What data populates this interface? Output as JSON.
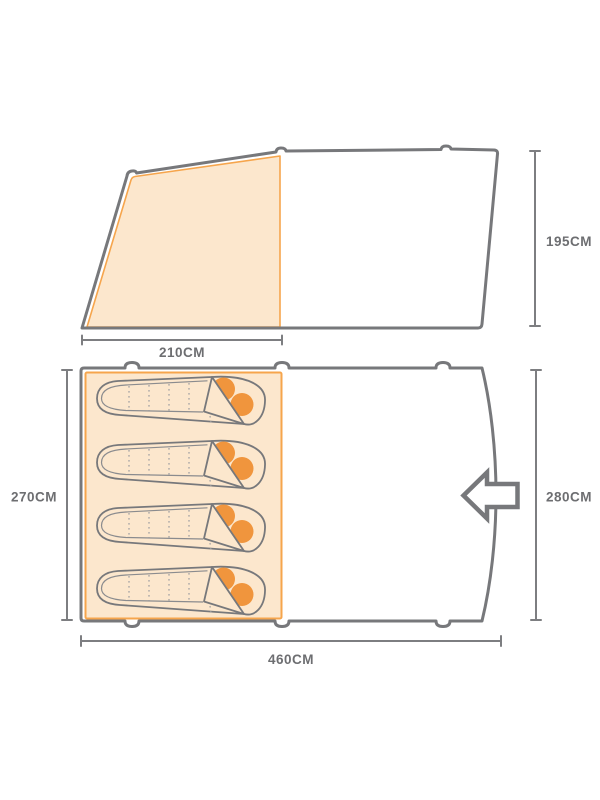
{
  "diagram": {
    "kind": "tent dimensions diagram",
    "side_view": {
      "height_label": "195CM",
      "inner_width_label": "210CM"
    },
    "floor_plan": {
      "width_label": "460CM",
      "depth_label": "280CM",
      "inner_depth_label": "270CM",
      "sleeping_bag_count": 4,
      "door_arrow_direction": "left"
    },
    "colors": {
      "outline_gray": "#77787b",
      "dimension_gray": "#7d7e81",
      "label_gray": "#6d6e71",
      "inner_tent_fill": "#fce7cd",
      "inner_tent_stroke": "#f6a54c",
      "pillow_orange": "#f0953d"
    }
  }
}
